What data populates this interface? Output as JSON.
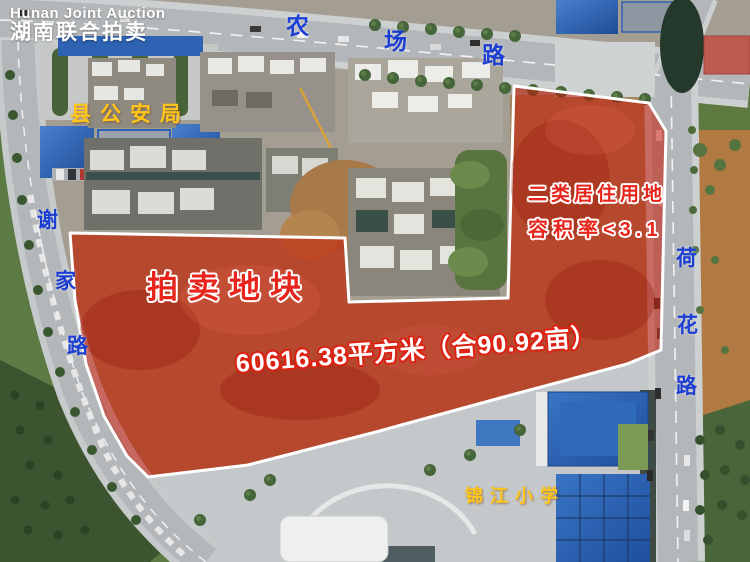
{
  "watermark": {
    "en": "Hunan Joint Auction",
    "zh": "湖南联合拍卖"
  },
  "roads": {
    "nongchang": {
      "name": "农场路",
      "chars": [
        "农",
        "场",
        "路"
      ]
    },
    "xiejia": {
      "name": "谢家路",
      "chars": [
        "谢",
        "家",
        "路"
      ]
    },
    "hehua": {
      "name": "荷花路",
      "chars": [
        "荷",
        "花",
        "路"
      ]
    }
  },
  "landmarks": {
    "police_bureau": "县公安局",
    "primary_school": "锦江小学"
  },
  "auction_plot": {
    "title": "拍卖地块",
    "area": "60616.38平方米（合90.92亩）",
    "land_use": "二类居住用地",
    "plot_ratio": "容积率<3.1"
  },
  "colors": {
    "road_label_blue": "#1c3ed2",
    "landmark_yellow": "#ffc61a",
    "plot_text_red": "#e8251c",
    "overlay_red": "#c41708",
    "border_white": "#ffffff"
  }
}
